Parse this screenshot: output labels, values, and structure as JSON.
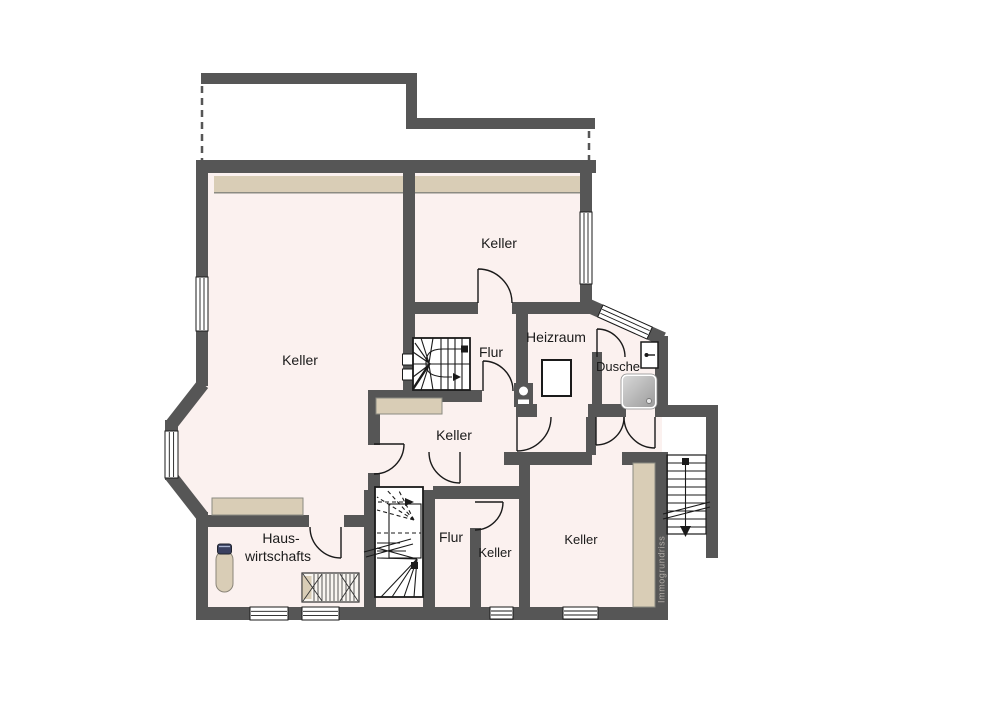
{
  "plan": {
    "type": "basement-floor-plan",
    "watermark": {
      "text": "Immogrundriss"
    }
  },
  "rooms": {
    "keller_top": {
      "label": "Keller"
    },
    "keller_left": {
      "label": "Keller"
    },
    "keller_middle": {
      "label": "Keller"
    },
    "keller_small": {
      "label": "Keller"
    },
    "keller_bottom_right": {
      "label": "Keller"
    },
    "flur_upper": {
      "label": "Flur"
    },
    "flur_lower": {
      "label": "Flur"
    },
    "heizraum": {
      "label": "Heizraum"
    },
    "dusche": {
      "label": "Dusche"
    },
    "hauswirtschaft": {
      "label_line1": "Haus-",
      "label_line2": "wirtschafts"
    }
  },
  "colors": {
    "wall": "#565656",
    "room_fill": "#fbf1ef",
    "furniture_beige": "#d9cdb6",
    "line_black": "#1a1a1a",
    "watermark_gray": "#b0aba6",
    "background": "#ffffff"
  }
}
